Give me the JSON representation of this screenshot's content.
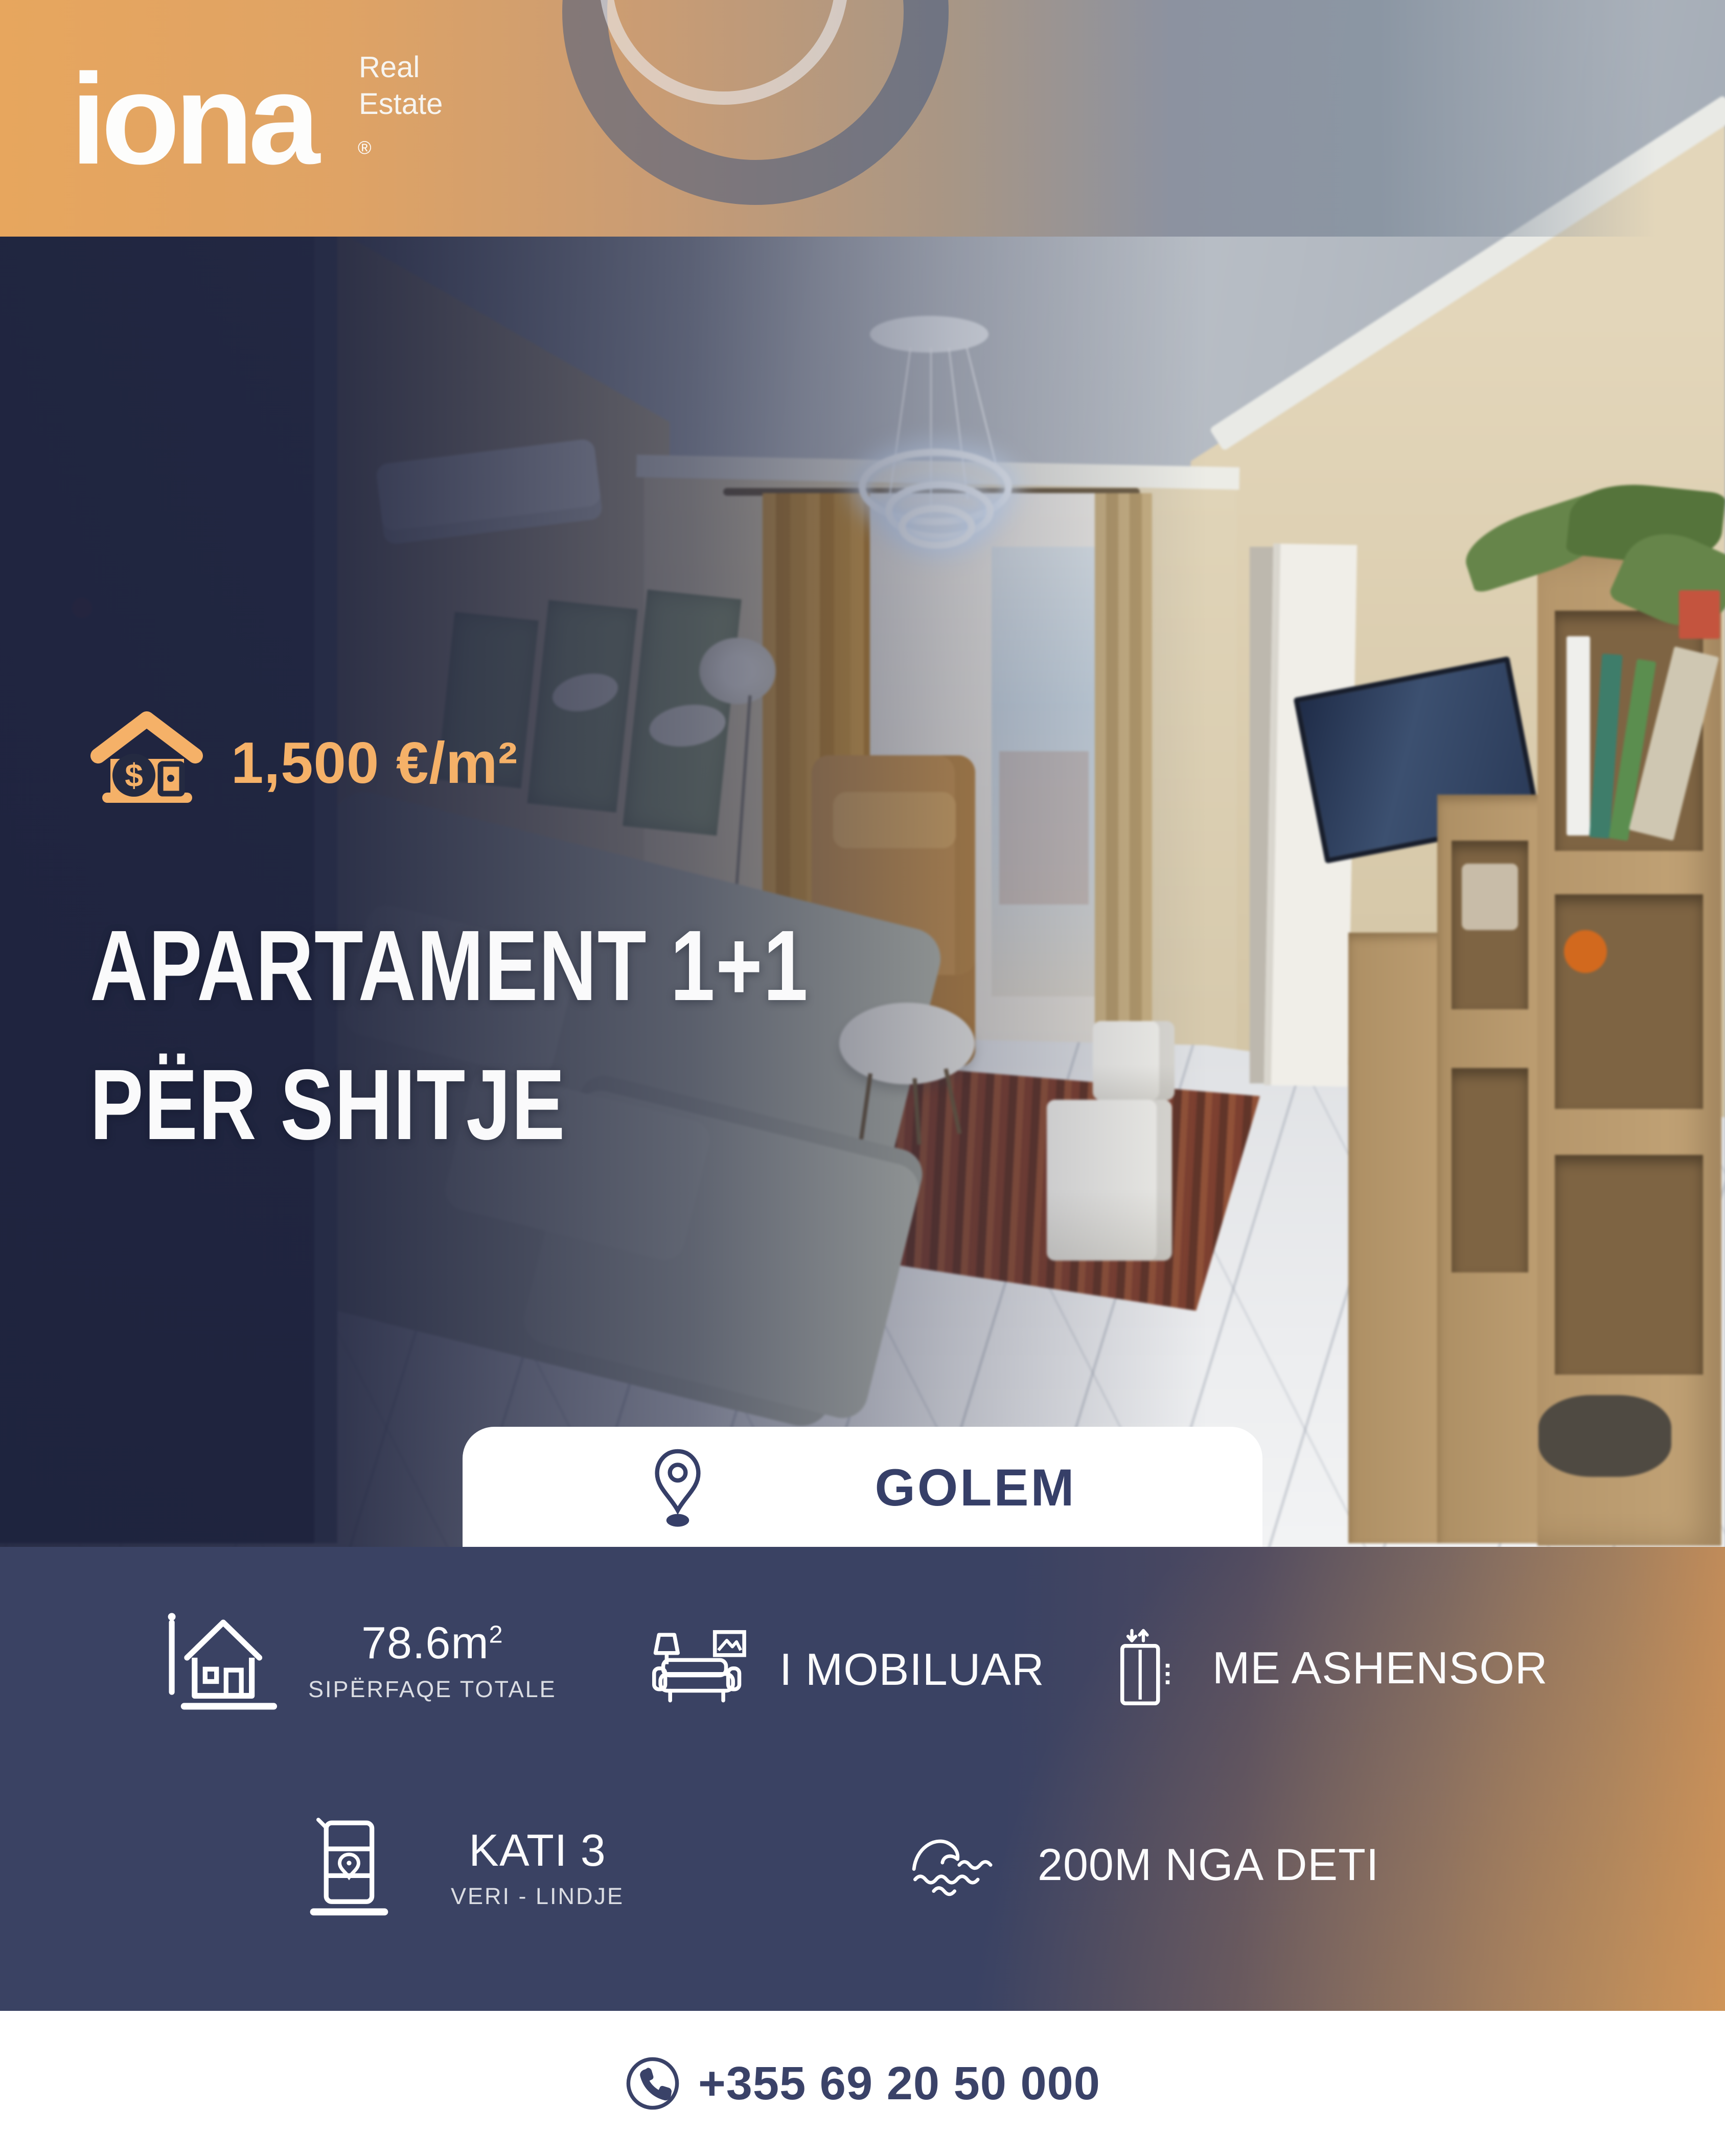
{
  "brand": {
    "name": "iona",
    "tagline_line1": "Real",
    "tagline_line2": "Estate",
    "registered_mark": "®"
  },
  "listing": {
    "price_per_m2": "1,500 €/m²",
    "title_line1": "APARTAMENT 1+1",
    "title_line2": "PËR SHITJE",
    "location": "GOLEM"
  },
  "features": {
    "area": {
      "value": "78.6m",
      "sup": "2",
      "label": "SIPËRFAQE TOTALE"
    },
    "furnished": {
      "value": "I MOBILUAR"
    },
    "elevator": {
      "value": "ME ASHENSOR"
    },
    "floor": {
      "value": "KATI 3",
      "label": "VERI - LINDJE"
    },
    "sea_distance": {
      "value": "200M NGA DETI"
    }
  },
  "contact": {
    "phone": "+355 69 20 50 000"
  },
  "colors": {
    "accent_orange": "#F5B168",
    "header_orange": "#E7A65E",
    "band_navy": "#3A4263",
    "text_navy": "#3A4268",
    "white": "#FFFFFF"
  }
}
